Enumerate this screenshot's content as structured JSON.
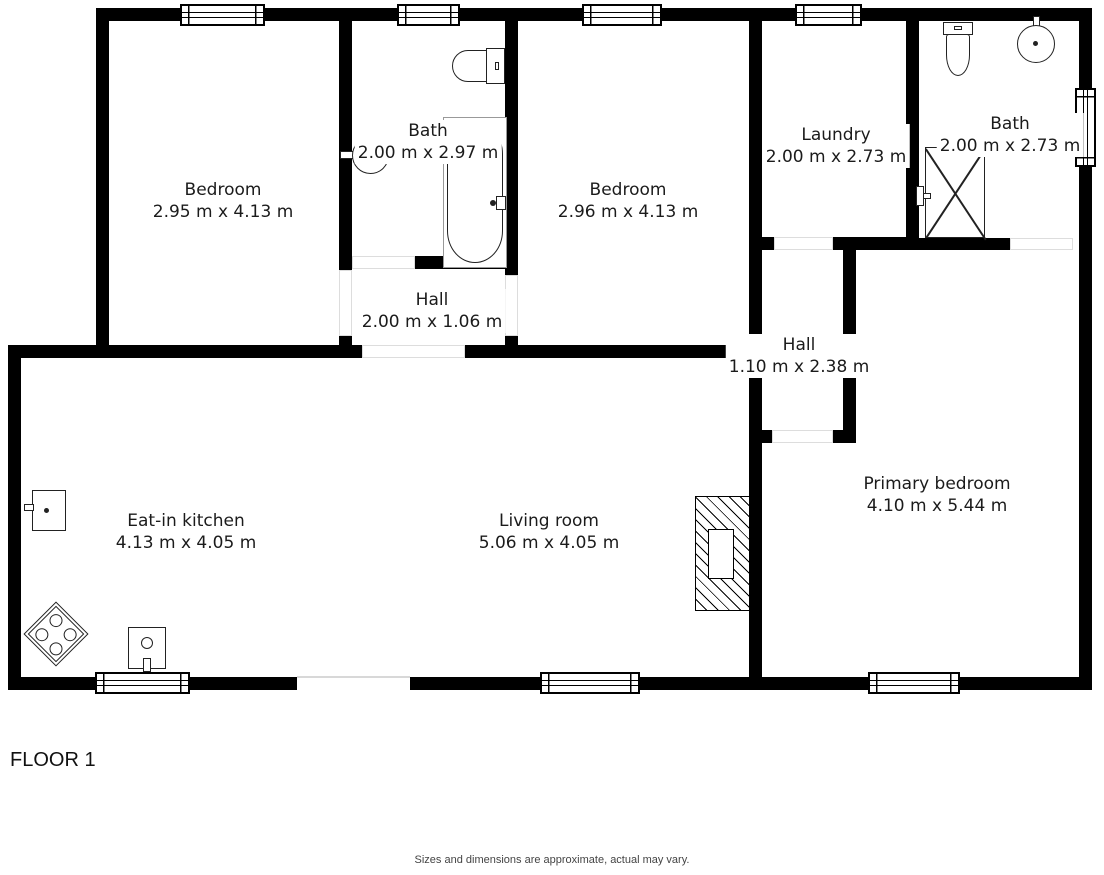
{
  "floor_label": "FLOOR 1",
  "disclaimer": "Sizes and dimensions are approximate, actual may vary.",
  "rooms": [
    {
      "id": "bedroom-left",
      "name": "Bedroom",
      "dims": "2.95 m x 4.13 m"
    },
    {
      "id": "bath-left",
      "name": "Bath",
      "dims": "2.00 m x 2.97 m"
    },
    {
      "id": "bedroom-middle",
      "name": "Bedroom",
      "dims": "2.96 m x 4.13 m"
    },
    {
      "id": "laundry",
      "name": "Laundry",
      "dims": "2.00 m x 2.73 m"
    },
    {
      "id": "bath-right",
      "name": "Bath",
      "dims": "2.00 m x 2.73 m"
    },
    {
      "id": "hall-left",
      "name": "Hall",
      "dims": "2.00 m x 1.06 m"
    },
    {
      "id": "hall-right",
      "name": "Hall",
      "dims": "1.10 m x 2.38 m"
    },
    {
      "id": "eat-in-kitchen",
      "name": "Eat-in kitchen",
      "dims": "4.13 m x 4.05 m"
    },
    {
      "id": "living-room",
      "name": "Living room",
      "dims": "5.06 m x 4.05 m"
    },
    {
      "id": "primary-bedroom",
      "name": "Primary bedroom",
      "dims": "4.10 m x 5.44 m"
    }
  ],
  "fixtures": {
    "bath_left": [
      "toilet",
      "sink",
      "bathtub"
    ],
    "bath_right": [
      "toilet",
      "sink",
      "shower"
    ],
    "kitchen": [
      "refrigerator",
      "stove",
      "sink"
    ],
    "living_room": [
      "fireplace"
    ]
  },
  "colors": {
    "wall": "#000000",
    "background": "#ffffff",
    "text": "#1b1b1b",
    "muted": "#444444",
    "opening_outline": "#dddddd"
  }
}
